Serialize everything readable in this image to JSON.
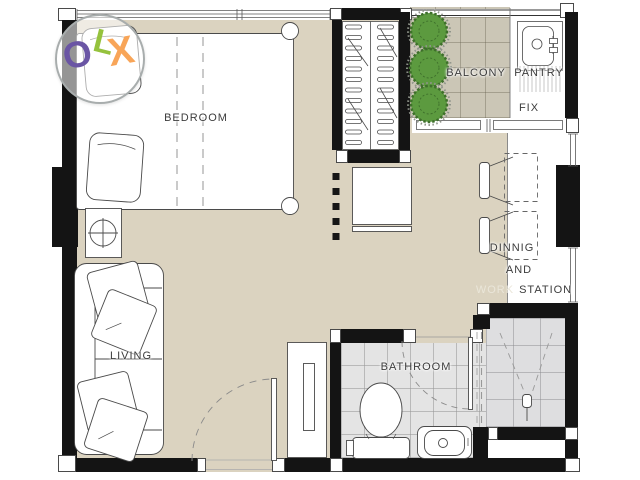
{
  "watermark": {
    "o": "O",
    "l": "L",
    "x": "X"
  },
  "labels": {
    "bedroom": "BEDROOM",
    "living": "LIVING",
    "bathroom": "BATHROOM",
    "balcony": "BALCONY",
    "pantry": "PANTRY",
    "fix": "FIX",
    "dining_line1": "DINNIG",
    "dining_line2": "AND",
    "dining_line3_light": "WORK",
    "dining_line3_dark": "STATION"
  },
  "colors": {
    "wall": "#141414",
    "floor_main": "#DBD3C0",
    "tile_balcony": "#CBC6B6",
    "tile_bath": "#E4E4E4",
    "tile_shower": "#DEDEE0",
    "bush_fill": "#5C9A3F",
    "bush_dark": "#3E6F2B",
    "olx_o": "#6A55A4",
    "olx_l": "#95C23D",
    "olx_x": "#F8A558",
    "text_dark": "#3C3C3C",
    "text_light": "#EAE6D9",
    "line": "#4A4A4A"
  }
}
